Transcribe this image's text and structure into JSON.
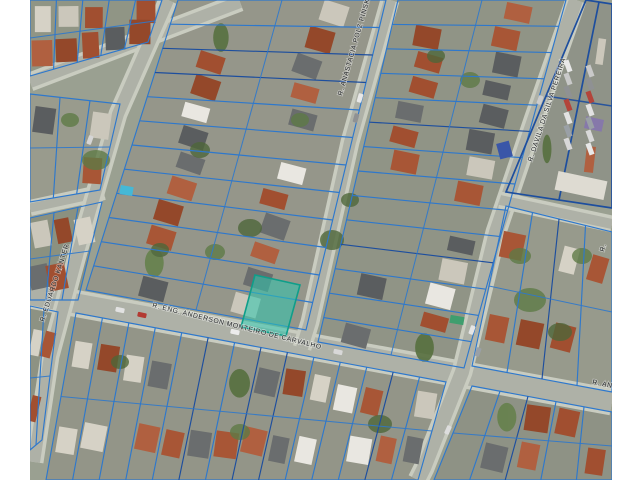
{
  "view": {
    "title": "aerial-cadastral-map",
    "canvas": {
      "width": 640,
      "height": 480,
      "letterbox_color": "#ffffff"
    },
    "colors": {
      "base": "#9aa091",
      "road": "#aeb1a7",
      "road_edge": "#c9ccc0",
      "parcel_stroke": "#2e78cc",
      "parcel_stroke_dark": "#1d4e9e",
      "highlight_fill": "#2ec7ae",
      "highlight_stroke": "#0f9e8a",
      "label_color": "#26292b"
    },
    "labels": [
      {
        "text": "R. ENG. ANDERSON MONTEIRO DE CARVALHO",
        "x": 152,
        "y": 307,
        "angle": 14
      },
      {
        "text": "R. ANASTACIA POLZ PINSKI",
        "x": 342,
        "y": 96,
        "angle": -74
      },
      {
        "text": "R. DAVILA DA SILVA PEREIRA",
        "x": 532,
        "y": 162,
        "angle": -72
      },
      {
        "text": "R. EDUARDO KANTER",
        "x": 44,
        "y": 322,
        "angle": -72
      },
      {
        "text": "R. AN",
        "x": 592,
        "y": 384,
        "angle": 11
      },
      {
        "text": "R.",
        "x": 604,
        "y": 252,
        "angle": -75
      }
    ],
    "highlight": {
      "name": "selected-parcel",
      "polygon": [
        [
          255,
          275
        ],
        [
          300,
          285
        ],
        [
          286,
          336
        ],
        [
          241,
          327
        ]
      ]
    },
    "roads": [
      {
        "points": [
          [
            30,
            82
          ],
          [
            240,
            2
          ]
        ],
        "w": 12
      },
      {
        "points": [
          [
            30,
            208
          ],
          [
            104,
            192
          ]
        ],
        "w": 9
      },
      {
        "points": [
          [
            30,
            295
          ],
          [
            612,
            402
          ]
        ],
        "w": 20
      },
      {
        "points": [
          [
            168,
            0
          ],
          [
            118,
            114
          ],
          [
            78,
            252
          ],
          [
            50,
            356
          ],
          [
            34,
            462
          ]
        ],
        "w": 12
      },
      {
        "points": [
          [
            390,
            0
          ],
          [
            350,
            142
          ],
          [
            310,
            322
          ],
          [
            302,
            348
          ]
        ],
        "w": 12
      },
      {
        "points": [
          [
            576,
            0
          ],
          [
            534,
            120
          ],
          [
            496,
            232
          ],
          [
            462,
            372
          ],
          [
            424,
            468
          ],
          [
            418,
            480
          ]
        ],
        "w": 14
      },
      {
        "points": [
          [
            500,
            200
          ],
          [
            612,
            224
          ]
        ],
        "w": 10
      }
    ],
    "blocks": [
      {
        "poly": [
          [
            30,
            0
          ],
          [
            162,
            0
          ],
          [
            148,
            42
          ],
          [
            30,
            76
          ]
        ],
        "orient": "v",
        "base": "#909585",
        "seed": 11
      },
      {
        "poly": [
          [
            30,
            94
          ],
          [
            120,
            104
          ],
          [
            100,
            190
          ],
          [
            30,
            202
          ]
        ],
        "orient": "v",
        "base": "#999b8d",
        "seed": 22
      },
      {
        "poly": [
          [
            30,
            218
          ],
          [
            102,
            202
          ],
          [
            78,
            300
          ],
          [
            30,
            300
          ]
        ],
        "orient": "v",
        "base": "#8b9180",
        "seed": 33
      },
      {
        "poly": [
          [
            178,
            0
          ],
          [
            386,
            0
          ],
          [
            306,
            330
          ],
          [
            86,
            290
          ]
        ],
        "orient": "h",
        "base": "#95968a",
        "seed": 44
      },
      {
        "poly": [
          [
            398,
            0
          ],
          [
            566,
            0
          ],
          [
            464,
            368
          ],
          [
            318,
            342
          ]
        ],
        "orient": "h",
        "base": "#909486",
        "seed": 55
      },
      {
        "poly": [
          [
            586,
            0
          ],
          [
            612,
            4
          ],
          [
            612,
            208
          ],
          [
            506,
            192
          ]
        ],
        "orient": "v",
        "base": "#8f9388",
        "seed": 66,
        "dark": true
      },
      {
        "poly": [
          [
            506,
            206
          ],
          [
            612,
            232
          ],
          [
            612,
            392
          ],
          [
            472,
            366
          ]
        ],
        "orient": "v",
        "base": "#979a8c",
        "seed": 77
      },
      {
        "poly": [
          [
            30,
            306
          ],
          [
            58,
            312
          ],
          [
            42,
            440
          ],
          [
            30,
            450
          ]
        ],
        "orient": "v",
        "base": "#8d9283",
        "seed": 88
      },
      {
        "poly": [
          [
            76,
            313
          ],
          [
            446,
            382
          ],
          [
            418,
            480
          ],
          [
            46,
            480
          ]
        ],
        "orient": "v",
        "base": "#939588",
        "seed": 99
      },
      {
        "poly": [
          [
            472,
            386
          ],
          [
            612,
            412
          ],
          [
            612,
            480
          ],
          [
            434,
            480
          ]
        ],
        "orient": "v",
        "base": "#8e9285",
        "seed": 12
      }
    ],
    "features": [
      {
        "name": "swimming-pool",
        "x": 120,
        "y": 186,
        "w": 13,
        "h": 9,
        "rot": 10,
        "fill": "#45b8d6"
      },
      {
        "name": "blue-roof-building",
        "x": 498,
        "y": 142,
        "w": 13,
        "h": 16,
        "rot": -15,
        "fill": "#3a56a8"
      },
      {
        "name": "purple-roof-building",
        "x": 585,
        "y": 118,
        "w": 18,
        "h": 12,
        "rot": 12,
        "fill": "#8678aa"
      },
      {
        "name": "white-commercial-building",
        "x": 556,
        "y": 176,
        "w": 50,
        "h": 19,
        "rot": 12,
        "fill": "#dedbd2"
      },
      {
        "name": "green-vehicle",
        "x": 450,
        "y": 316,
        "w": 14,
        "h": 8,
        "rot": 10,
        "fill": "#3f9e6e"
      }
    ],
    "trees": [
      [
        96,
        160,
        14,
        10
      ],
      [
        250,
        228,
        12,
        9
      ],
      [
        215,
        252,
        10,
        8
      ],
      [
        332,
        240,
        12,
        10
      ],
      [
        530,
        300,
        16,
        12
      ],
      [
        560,
        332,
        12,
        9
      ],
      [
        470,
        80,
        10,
        8
      ],
      [
        436,
        56,
        9,
        7
      ],
      [
        300,
        120,
        9,
        7
      ],
      [
        160,
        250,
        9,
        7
      ],
      [
        520,
        256,
        11,
        8
      ],
      [
        380,
        424,
        12,
        9
      ],
      [
        240,
        432,
        10,
        8
      ],
      [
        120,
        362,
        9,
        7
      ],
      [
        582,
        256,
        10,
        8
      ],
      [
        200,
        150,
        10,
        8
      ],
      [
        70,
        120,
        9,
        7
      ],
      [
        350,
        200,
        9,
        7
      ]
    ],
    "cars": [
      [
        120,
        310,
        12,
        "#e2e2e2"
      ],
      [
        142,
        315,
        12,
        "#b33a32"
      ],
      [
        235,
        332,
        12,
        "#ececec"
      ],
      [
        338,
        352,
        12,
        "#d8d8d8"
      ],
      [
        360,
        98,
        -74,
        "#e8e8e8"
      ],
      [
        356,
        118,
        -74,
        "#8f9193"
      ],
      [
        472,
        330,
        -70,
        "#e5e5e5"
      ],
      [
        478,
        352,
        -70,
        "#9aa0a6"
      ],
      [
        448,
        430,
        -66,
        "#dddddd"
      ],
      [
        540,
        100,
        -71,
        "#cccccc"
      ],
      [
        90,
        140,
        -70,
        "#d5d5d5"
      ]
    ],
    "parking": {
      "cols": [
        568,
        590
      ],
      "y0": 66,
      "step": 13,
      "rows": 7,
      "rot": 70,
      "colors": [
        "#e8e8e8",
        "#c9c9c9",
        "#8f9193",
        "#b3443a",
        "#e2e2e2",
        "#9aa0a6",
        "#d8d8d8"
      ]
    }
  }
}
